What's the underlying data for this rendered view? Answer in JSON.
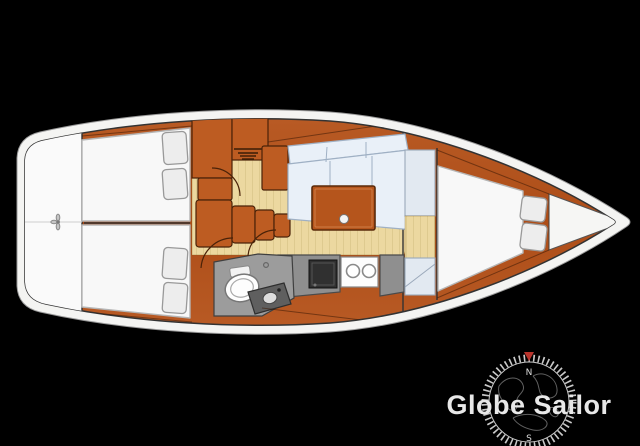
{
  "logo": {
    "brand": "Globe Sailor",
    "compass_north": "N",
    "compass_south": "S"
  },
  "palette": {
    "background": "#000000",
    "hull_white": "#f4f4f2",
    "wood": "#b4541f",
    "wood_dark": "#4a2208",
    "wood_light": "#bd5c22",
    "floor_tan": "#ecd8a0",
    "bed_white": "#f8f8f8",
    "bed_stroke": "#b5b5b5",
    "pillow_fill": "#ededed",
    "pillow_stroke": "#999999",
    "cushion_fill": "#e9f0f8",
    "cushion_stroke": "#9fb0c4",
    "counter_gray": "#8f8f8f",
    "appliance_dark": "#303030",
    "fixture_white": "#fdfdfd",
    "line_dark": "#333333",
    "logo_text": "#e8e8e8",
    "compass_ring": "#c9c9c9",
    "compass_red": "#b9342c"
  }
}
